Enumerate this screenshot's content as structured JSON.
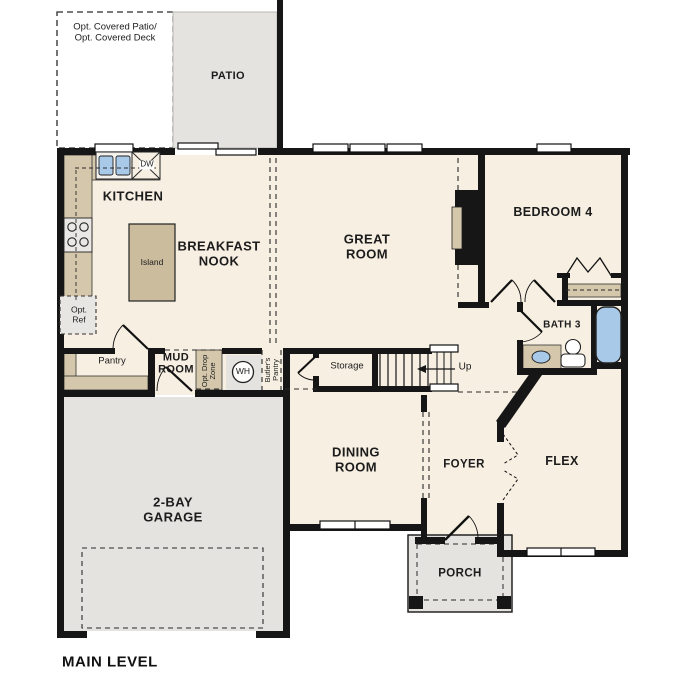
{
  "plan": {
    "title": "MAIN LEVEL",
    "labels": {
      "opt_covered": "Opt. Covered Patio/\nOpt. Covered Deck",
      "patio": "PATIO",
      "kitchen": "KITCHEN",
      "dw": "DW",
      "island": "Island",
      "opt_ref": "Opt.\nRef",
      "breakfast_nook": "BREAKFAST\nNOOK",
      "great_room": "GREAT\nROOM",
      "bedroom4": "BEDROOM 4",
      "bath3": "BATH 3",
      "pantry": "Pantry",
      "mud_room": "MUD\nROOM",
      "opt_drop_zone": "Opt. Drop\nZone",
      "wh": "WH",
      "butlers_pantry": "Butler's\nPantry",
      "storage": "Storage",
      "up": "Up",
      "garage": "2-BAY\nGARAGE",
      "dining": "DINING\nROOM",
      "foyer": "FOYER",
      "flex": "FLEX",
      "porch": "PORCH"
    },
    "colors": {
      "floor": "#f7efe2",
      "hard_surface_gray": "#e4e3e0",
      "casework_tan": "#d4c7ab",
      "island_tan": "#cbbc9e",
      "fixture_blue": "#a9c9e9",
      "wall_black": "#161616"
    }
  }
}
